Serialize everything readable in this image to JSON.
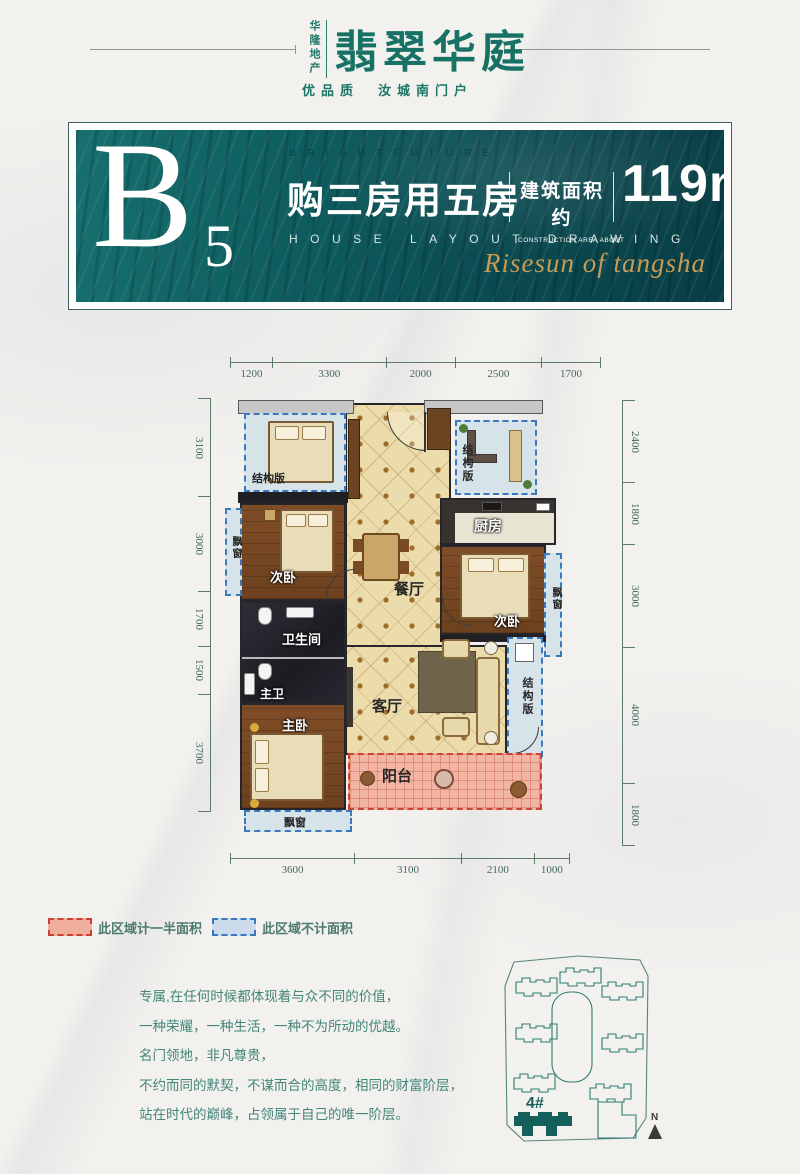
{
  "header": {
    "brand_vertical": "华隆地产",
    "logo_text": "翡翠华庭",
    "tagline": "优品质　汝城南门户"
  },
  "banner": {
    "unit_letter": "B",
    "unit_number": "5",
    "kicker_en": "BRIGHTFUTURE",
    "headline": "购三房用五房",
    "area_label_cn": "建筑面积约",
    "area_label_en": "CONSTRUCTION AREA ABOUT",
    "area_value": "119m",
    "area_sup": "2",
    "subtitle_en": "HOUSE LAYOUT DRAWING",
    "script_text": "Risesun of tangsha",
    "accent_teal": "#0d5a5e",
    "accent_gold": "#c79b55"
  },
  "floorplan": {
    "dims_top": [
      "1200",
      "3300",
      "2000",
      "2500",
      "1700"
    ],
    "dims_left": [
      "3100",
      "3000",
      "1700",
      "1500",
      "3700"
    ],
    "dims_right": [
      "2400",
      "1800",
      "3000",
      "4000",
      "1800"
    ],
    "dims_bottom": [
      "3600",
      "3100",
      "2100",
      "1000"
    ],
    "rooms": {
      "structure": "结构版",
      "dining": "餐厅",
      "kitchen": "厨房",
      "bedroom2": "次卧",
      "bathroom": "卫生间",
      "master_bath": "主卫",
      "master_bedroom": "主卧",
      "living": "客厅",
      "balcony": "阳台",
      "bay_window": "飘窗"
    }
  },
  "legend": {
    "half_area": "此区域计一半面积",
    "no_area": "此区域不计面积"
  },
  "copy": {
    "lines": [
      "专属,在任何时候都体现着与众不同的价值，",
      "一种荣耀，一种生活，一种不为所动的优越。",
      "名门领地，非凡尊贵，",
      "不约而同的默契，不谋而合的高度，相同的财富阶层，",
      "站在时代的巅峰，占领属于自己的唯一阶层。"
    ]
  },
  "siteplan": {
    "building_label": "4#",
    "north_label": "N"
  }
}
